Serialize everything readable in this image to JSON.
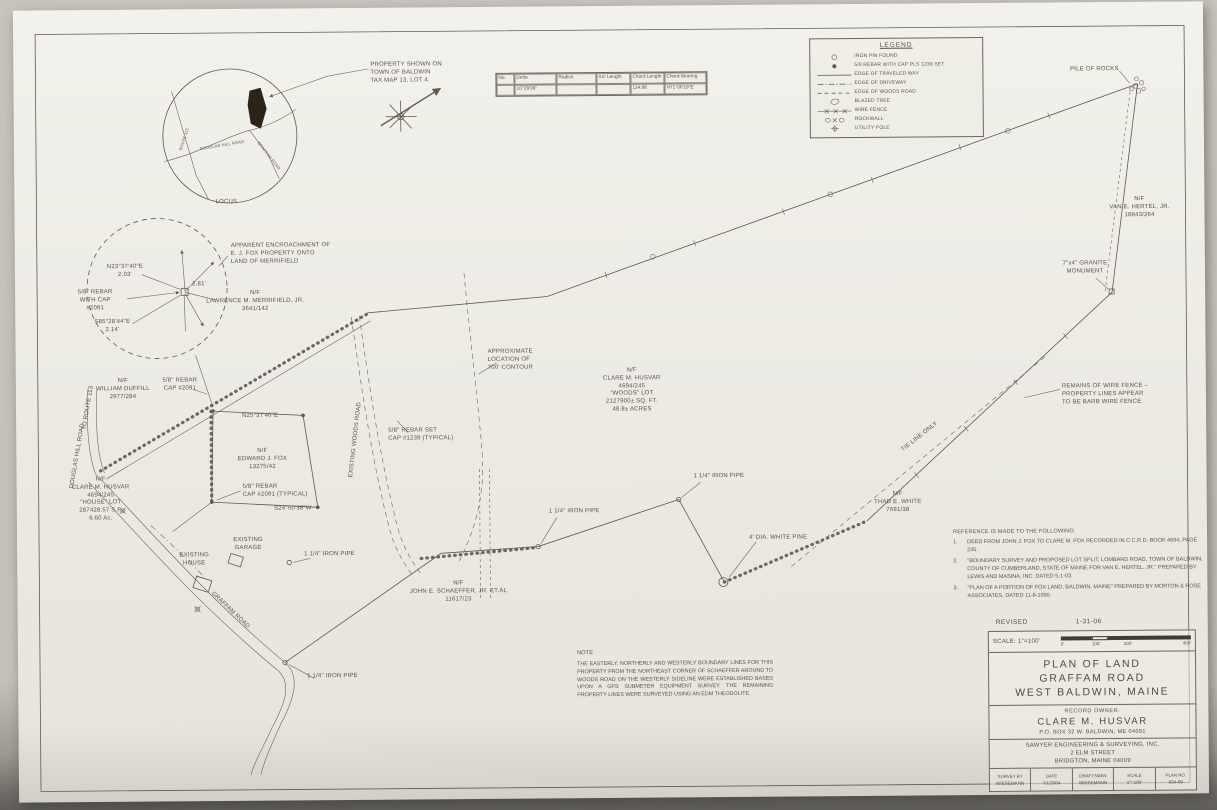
{
  "legend": {
    "title": "LEGEND",
    "items": [
      "IRON PIN FOUND",
      "5/8 REBAR WITH CAP PLS 1239 SET",
      "EDGE OF TRAVELED WAY",
      "EDGE OF DRIVEWAY",
      "EDGE OF WOODS ROAD",
      "BLAZED TREE",
      "WIRE FENCE",
      "ROCKWALL",
      "UTILITY POLE"
    ]
  },
  "curve_table": {
    "headers": [
      "No.",
      "Delta",
      "Radius",
      "Arc Length",
      "Chord Length",
      "Chord Bearing"
    ],
    "row": [
      "",
      "10°28'08\"",
      "",
      "",
      "114.98",
      "N71°06'19\"E"
    ]
  },
  "locus": {
    "callout": "PROPERTY SHOWN ON\nTOWN OF BALDWIN\nTAX MAP 13, LOT 4.",
    "label": "LOCUS",
    "road_left": "ROUTE 113",
    "road_middle": "DOUGLAS HILL ROAD",
    "road_right": "GRAFFAM ROAD"
  },
  "detail": {
    "callout": "APPARENT ENCROACHMENT OF\nE. J. FOX PROPERTY ONTO\nLAND OF MERRIFIELD",
    "bearing_top": "N23°37'40\"E\n2.03'",
    "rebar": "5/8\" REBAR\nWITH CAP\n#2091",
    "bearing_bottom": "S85°28'44\"E\n2.14'",
    "distance": "2.81'"
  },
  "parcels": {
    "woods": "N/F\nCLARE M. HUSVAR\n4694/245\n\"WOODS\" LOT\n2127900± SQ. FT.\n48.8± ACRES",
    "house": "N/F\nCLARE M. HUSVAR\n4694/245\n\"HOUSE\" LOT\n287428.57 S.F.\n6.60 Ac.",
    "fox": "N/F\nEDWARD J. FOX\n13275/42",
    "duffill": "N/F\nWILLIAM DUFFILL\n2977/284",
    "merrifield": "N/F\nLAWRENCE M. MERRIFIELD, JR.\n3641/142",
    "hertel": "N/F\nVAN E. HERTEL, JR.\n18843/264",
    "white": "N/F\nTHAD E. WHITE\n7691/38",
    "schaeffer": "N/F\nJOHN E. SCHAEFFER, JR. ET.AL\n11617/23"
  },
  "features": {
    "pile_of_rocks": "PILE OF ROCKS",
    "granite_monument": "7\"x4\" GRANITE\nMONUMENT",
    "wire_fence_remains": "REMAINS OF WIRE FENCE –\nPROPERTY LINES APPEAR\nTO BE BARB WIRE FENCE.",
    "tie_line": "TIE LINE ONLY",
    "iron_pipe": "1 1/4\" IRON PIPE",
    "white_pine": "4' DIA. WHITE PINE",
    "contour": "APPROXIMATE\nLOCATION OF\n700' CONTOUR",
    "rebar_set": "5/8\" REBAR SET\nCAP #1239 (TYPICAL)",
    "rebar_2091": "5/8\" REBAR\nCAP #2091",
    "rebar_typical": "5/8\" REBAR\nCAP #2091 (TYPICAL)",
    "bearing_top": "N25°37'40\"E",
    "bearing_bottom": "S24°50'38\"W",
    "existing_garage": "EXISTING\nGARAGE",
    "existing_house": "EXISTING\nHOUSE",
    "woods_road": "EXISTING WOODS ROAD",
    "to_route": "TO ROUTE 113",
    "douglas_hill": "DOUGLAS HILL ROAD",
    "graffam_road": "GRAFFAM ROAD"
  },
  "note": {
    "title": "NOTE",
    "body": "THE EASTERLY, NORTHERLY AND WESTERLY BOUNDARY LINES FOR THIS PROPERTY FROM THE NORTHEAST CORNER OF SCHAEFFER AROUND TO WOODS ROAD ON THE WESTERLY SIDELINE WERE ESTABLISHED BASED UPON A GPS SUBMETER EQUIPMENT SURVEY. THE REMAINING PROPERTY LINES WERE SURVEYED USING AN EDM THEODOLITE."
  },
  "references": {
    "heading": "REFERENCE IS MADE TO THE FOLLOWING:",
    "items": [
      {
        "num": "1.",
        "text": "DEED FROM JOHN J. FOX TO CLARE M. FOX RECORDED IN C.C.R.D. BOOK 4694, PAGE 245."
      },
      {
        "num": "2.",
        "text": "\"BOUNDARY SURVEY AND PROPOSED LOT SPLIT, LOMBARD ROAD, TOWN OF BALDWIN, COUNTY OF CUMBERLAND, STATE OF MAINE FOR VAN E. HERTEL, JR.\" PREPARED BY LEWIS AND MASINA, INC. DATED 5-1-03."
      },
      {
        "num": "3.",
        "text": "\"PLAN OF A PORTION OF FOX LAND, BALDWIN, MAINE\" PREPARED BY MORTON & ROSE ASSOCIATES, DATED 11-6-1990."
      }
    ]
  },
  "title_block": {
    "revised_label": "REVISED",
    "revised_date": "1-31-06",
    "scale_label": "SCALE: 1\"=100'",
    "scale_ticks": [
      "0'",
      "100'",
      "200'",
      "400'"
    ],
    "title": "PLAN OF LAND\nGRAFFAM ROAD\nWEST BALDWIN, MAINE",
    "owner_heading": "RECORD OWNER:",
    "owner_name": "CLARE M. HUSVAR",
    "owner_address": "P.O. BOX 32 W. BALDWIN, ME 04091",
    "firm": "SAWYER ENGINEERING & SURVEYING, INC.\n2 ELM STREET\nBRIDGTON, MAINE 04009",
    "cells": [
      {
        "label": "SURVEY BY",
        "value": "WIESEMANN"
      },
      {
        "label": "DATE",
        "value": "7/1/2004"
      },
      {
        "label": "DRAFTSMAN",
        "value": "WIESEMANN"
      },
      {
        "label": "SCALE",
        "value": "1\"=100'"
      },
      {
        "label": "PLAN NO.",
        "value": "004-89"
      }
    ]
  }
}
